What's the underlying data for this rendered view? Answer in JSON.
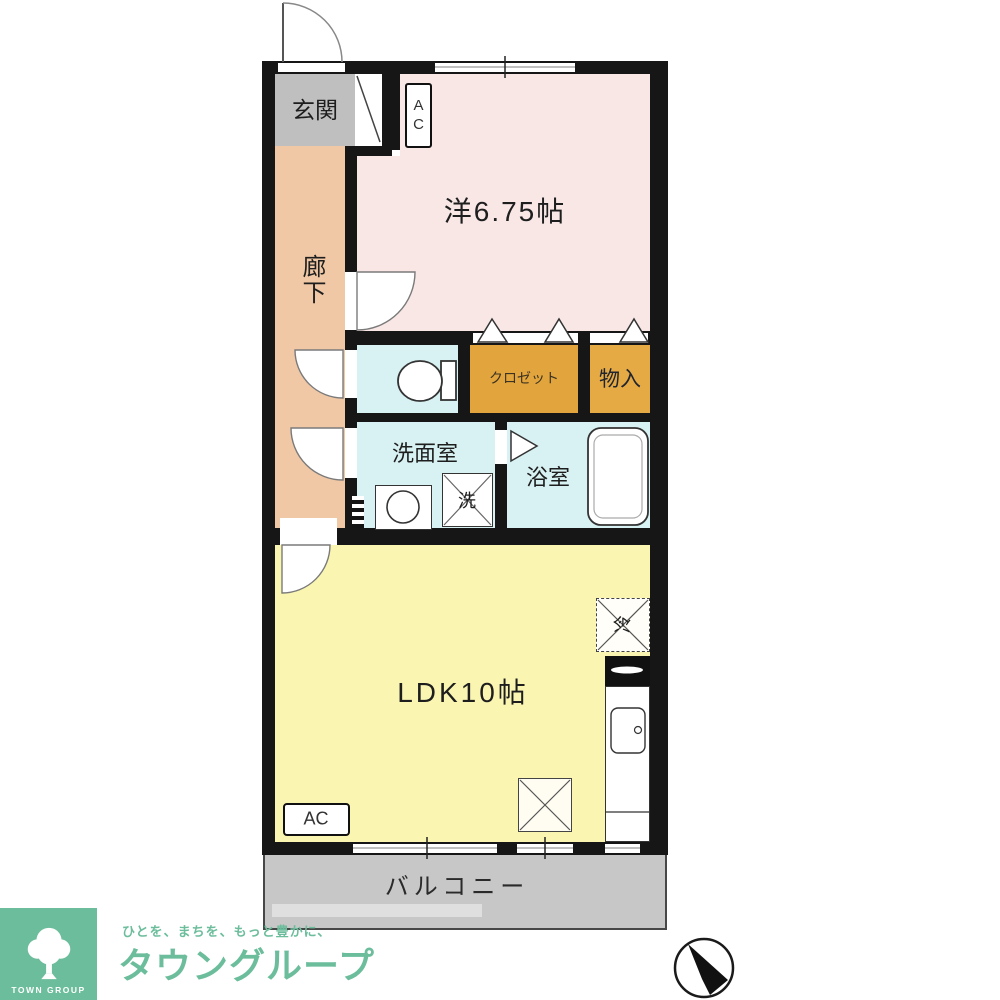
{
  "plan": {
    "entrance_label": "玄関",
    "hallway_label": "廊下",
    "western_room_label": "洋6.75帖",
    "closet_label": "クロゼット",
    "storage_label": "物入",
    "washroom_label": "洗面室",
    "bathroom_label": "浴室",
    "washer_label": "洗",
    "ldk_label": "LDK10帖",
    "fridge_label": "冷",
    "balcony_label": "バルコニー",
    "ac_top_label": "AC",
    "ac_bottom_label": "AC"
  },
  "branding": {
    "logo_box_text": "TOWN GROUP",
    "tagline": "ひとを、まちを、もっと豊かに、",
    "company_name": "タウングループ",
    "brand_green": "#6cbd9c"
  },
  "icons": {
    "compass": "north-arrow-icon",
    "logo": "tree-icon",
    "toilet": "toilet-icon",
    "bathtub": "bathtub-icon",
    "sink": "kitchen-sink-icon",
    "stove": "stove-icon",
    "washer": "washing-machine-icon",
    "doors": "door-swing-arc-icon",
    "closet_doors": "folding-door-triangle-icon"
  },
  "colors": {
    "wall": "#161616",
    "western_room": "#f8e7e5",
    "hallway": "#f0c8a6",
    "entrance": "#bfbfbf",
    "wet_area": "#d8f1f2",
    "closet": "#e2a43c",
    "storage": "#e6aa45",
    "ldk": "#faf6b2",
    "balcony": "#c7c7c7",
    "brand_green": "#6cbd9c"
  }
}
